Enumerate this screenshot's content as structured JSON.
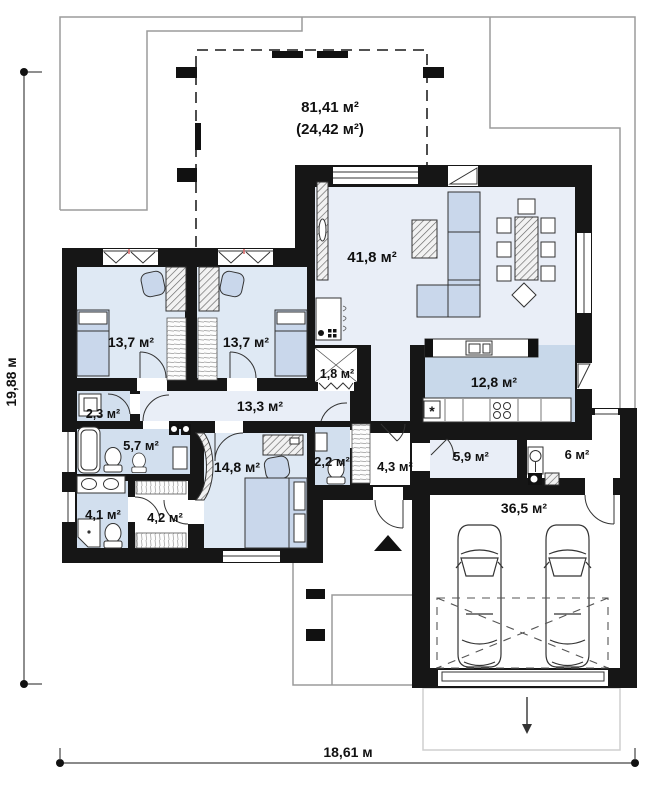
{
  "floor_plan": {
    "terrace": {
      "area_total": "81,41 м²",
      "area_secondary": "(24,42 м²)"
    },
    "rooms": {
      "living_room": "41,8 м²",
      "bedroom_left": "13,7 м²",
      "bedroom_right": "13,7 м²",
      "pantry": "1,8 м²",
      "hallway": "13,3 м²",
      "wc_small": "2,3 м²",
      "bathroom": "5,7 м²",
      "kitchen": "12,8 м²",
      "bedroom_master": "14,8 м²",
      "wc_second": "2,2 м²",
      "entry": "4,3 м²",
      "mudroom": "5,9 м²",
      "utility": "6 м²",
      "shower_room": "4,1 м²",
      "wardrobe": "4,2 м²",
      "garage": "36,5 м²"
    },
    "dimensions": {
      "side_left": "19,88 м",
      "side_bottom": "18,61 м"
    },
    "symbols": {
      "dishwasher": "*"
    },
    "colors": {
      "wall": "#161616",
      "room_light": "#e9eef7",
      "bedroom": "#dfe9f4",
      "wet_room": "#d2dfee",
      "kitchen_band": "#c8d8ea",
      "furniture": "#c9d7eb"
    }
  }
}
